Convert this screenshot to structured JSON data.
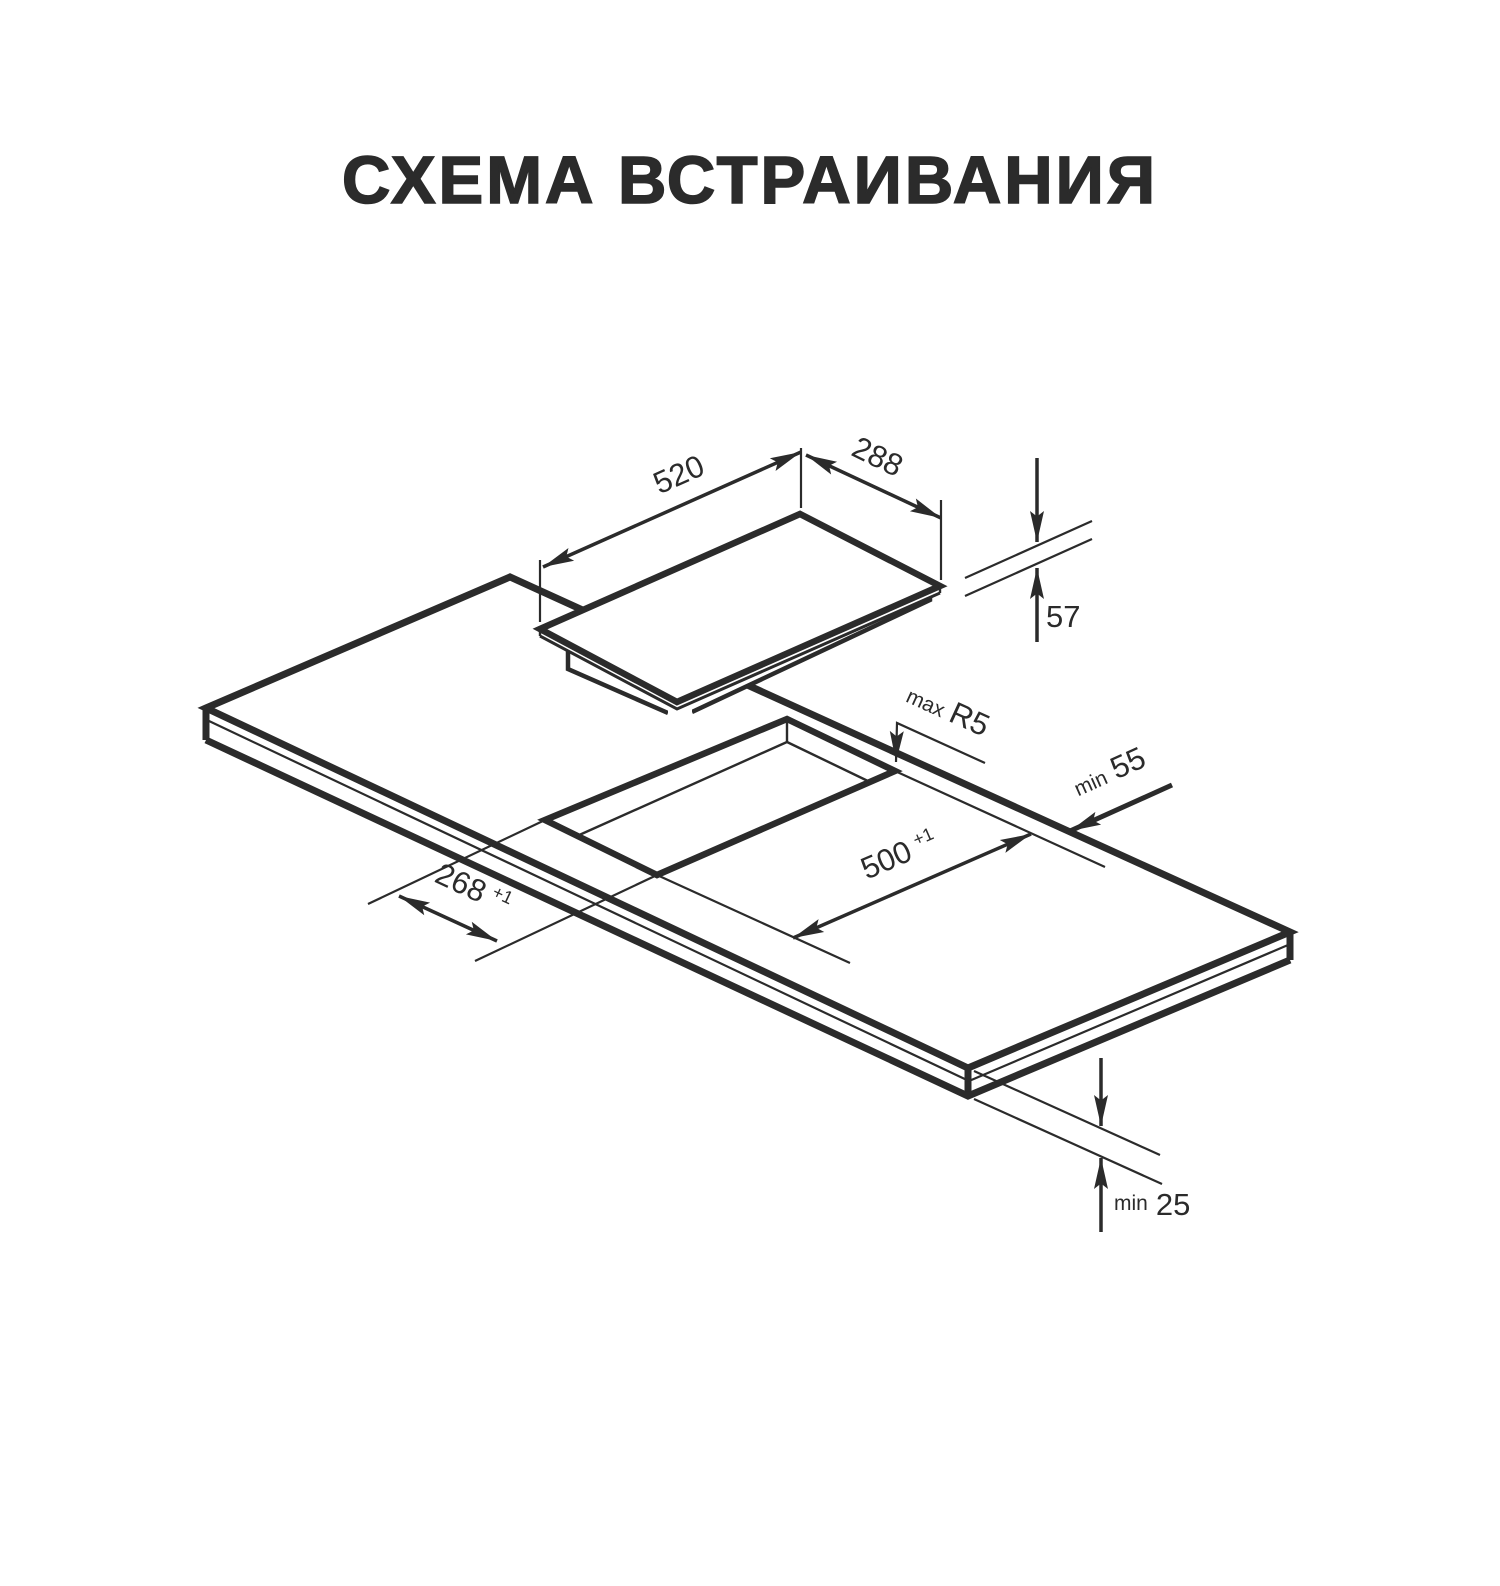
{
  "title": "СХЕМА ВСТРАИВАНИЯ",
  "colors": {
    "line": "#2b2b2b",
    "background": "#ffffff"
  },
  "dims": {
    "hob_width": {
      "value": "520"
    },
    "hob_depth": {
      "value": "288"
    },
    "hob_height": {
      "value": "57"
    },
    "corner_radius": {
      "prefix": "max",
      "value": "R5"
    },
    "back_clearance": {
      "prefix": "min",
      "value": "55"
    },
    "cutout_length": {
      "value": "500",
      "tol": "+1"
    },
    "cutout_width": {
      "value": "268",
      "tol": "+1"
    },
    "bottom_clearance": {
      "prefix": "min",
      "value": "25"
    }
  }
}
